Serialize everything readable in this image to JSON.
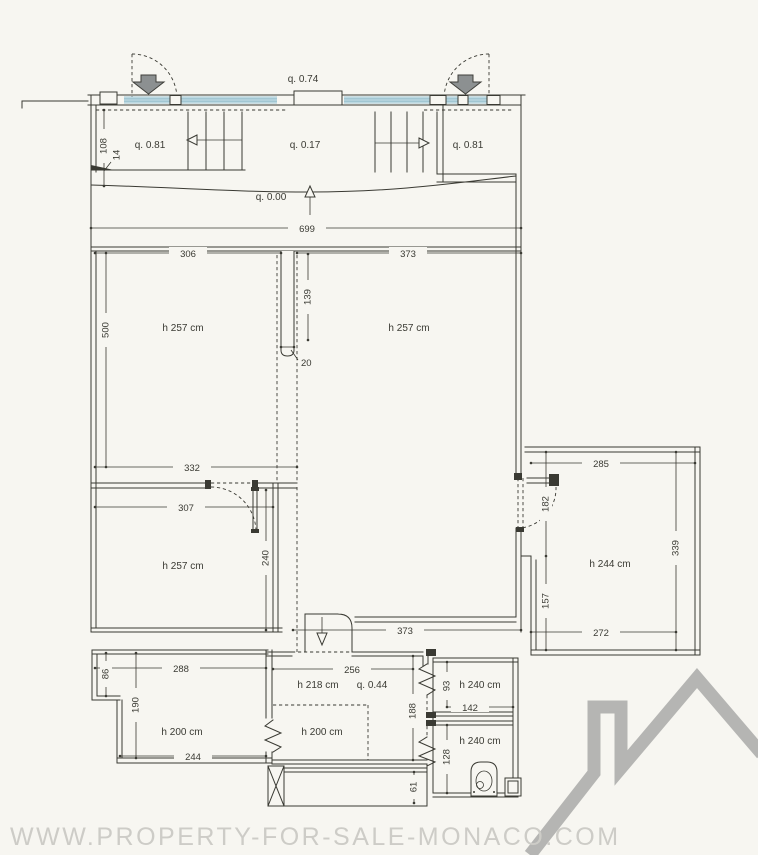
{
  "watermark": "WWW.PROPERTY-FOR-SALE-MONACO.COM",
  "levels": {
    "terrace": "q. 0.74",
    "landing_left": "q. 0.81",
    "entry": "q. 0.17",
    "landing_right": "q. 0.81",
    "main_floor": "q. 0.00",
    "lower_zone": "q. 0.44"
  },
  "rooms": {
    "living_left": "h 257 cm",
    "living_right": "h 257 cm",
    "bedroom_left": "h 257 cm",
    "bedroom_right": "h 244 cm",
    "lower_left": "h 200 cm",
    "lower_mid_upper": "h 218 cm",
    "lower_mid": "h 200 cm",
    "bath_upper": "h 240 cm",
    "bath_lower": "h 240 cm"
  },
  "dims": {
    "d699": "699",
    "d306": "306",
    "d373_top": "373",
    "d500": "500",
    "d139": "139",
    "d20": "20",
    "d332": "332",
    "d307": "307",
    "d240": "240",
    "d373_bottom": "373",
    "d285": "285",
    "d182": "182",
    "d157": "157",
    "d339": "339",
    "d272": "272",
    "d288": "288",
    "d86": "86",
    "d190": "190",
    "d244": "244",
    "d256": "256",
    "d188": "188",
    "d61": "61",
    "d93": "93",
    "d142": "142",
    "d128": "128",
    "d108": "108",
    "d14": "14"
  },
  "colors": {
    "paper": "#f7f6f1",
    "ink": "#3a3a33",
    "window_blue": "#bcd9e2",
    "window_stripe": "#8fb9c7",
    "arrow_gray": "#8c9091",
    "logo_gray": "#b5b5b3",
    "watermark_gray": "#cdccc7"
  }
}
